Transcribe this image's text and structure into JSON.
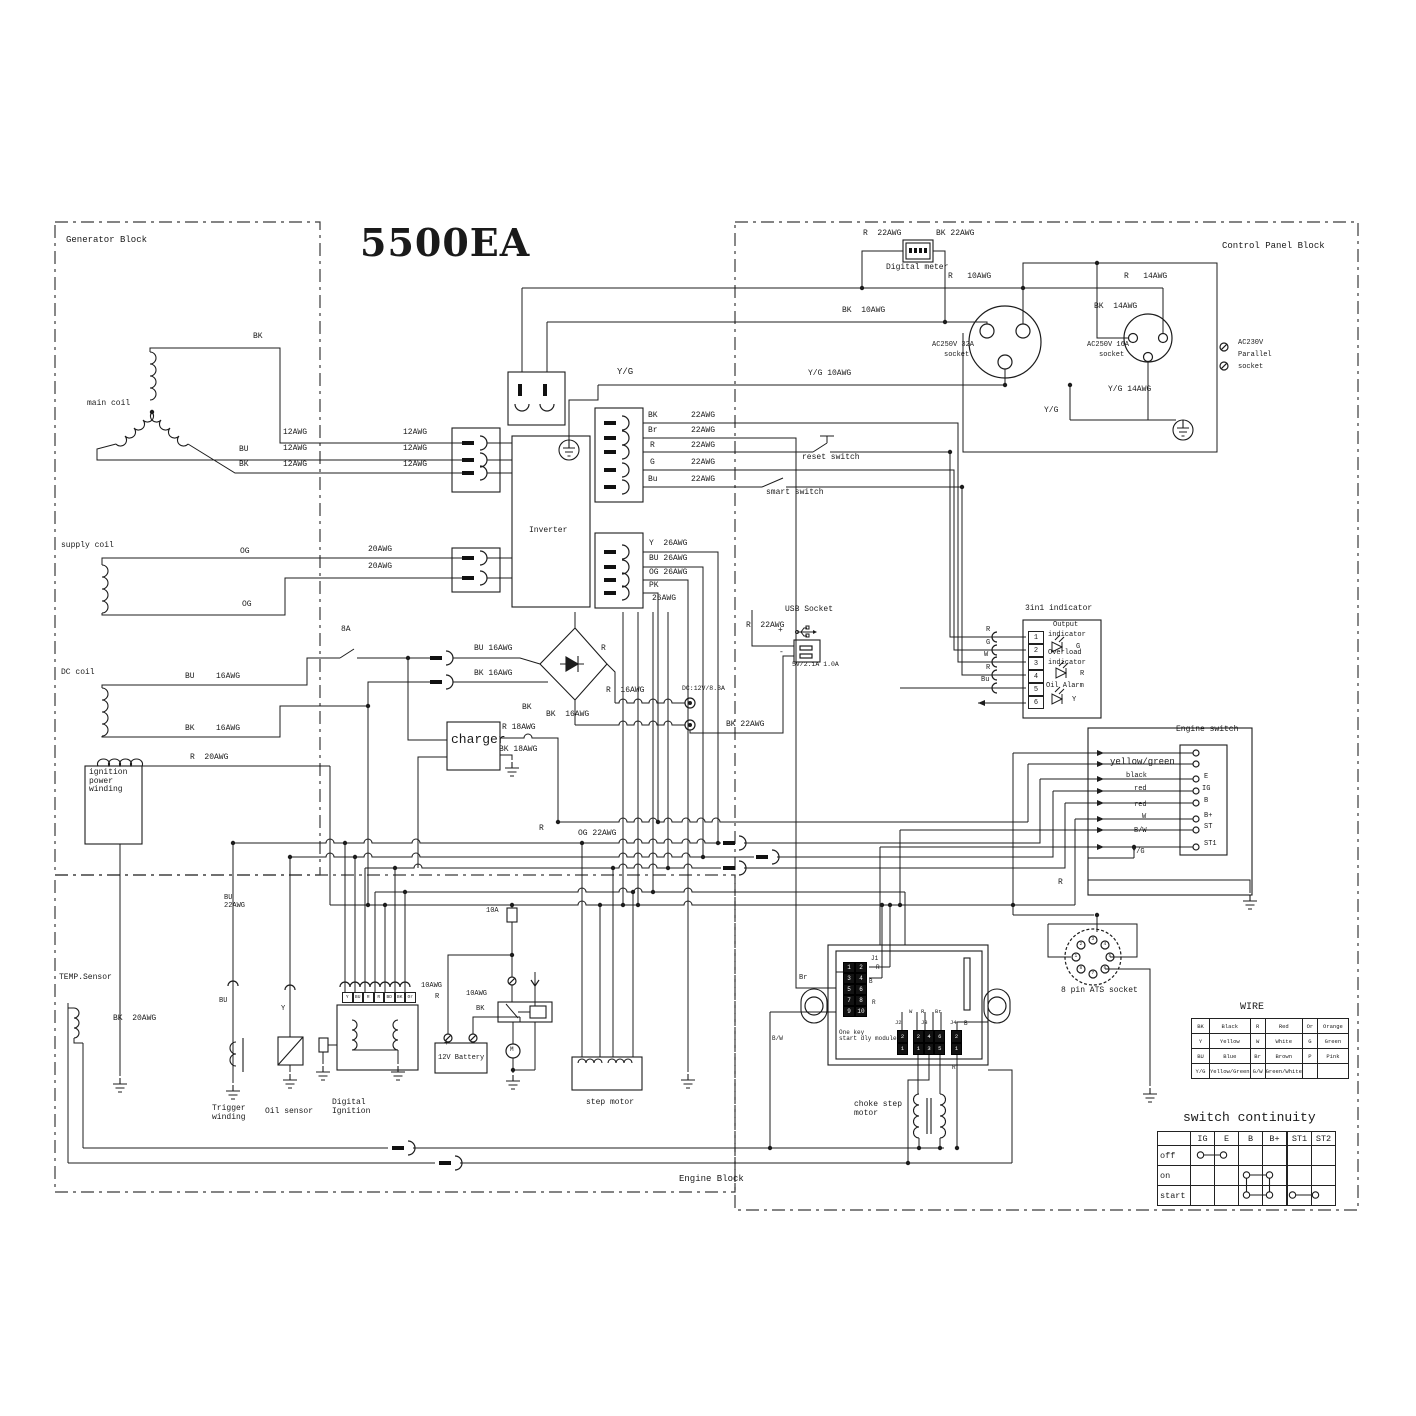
{
  "title": "5500EA",
  "blocks": {
    "generator": "Generator Block",
    "control": "Control Panel Block",
    "engine": "Engine Block"
  },
  "tables": {
    "wire": {
      "title": "WIRE",
      "rows": [
        [
          "BK",
          "Black",
          "R",
          "Red",
          "Or",
          "Orange"
        ],
        [
          "Y",
          "Yellow",
          "W",
          "White",
          "G",
          "Green"
        ],
        [
          "BU",
          "Blue",
          "Br",
          "Brown",
          "P",
          "Pink"
        ],
        [
          "Y/G",
          "Yellow/Green",
          "G/W",
          "Green/White",
          "",
          ""
        ]
      ]
    },
    "continuity": {
      "title": "switch continuity",
      "header": [
        "",
        "IG",
        "E",
        "B",
        "B+",
        "ST1",
        "ST2"
      ],
      "rows": [
        "off",
        "on",
        "start"
      ],
      "connections": {
        "off": [
          "IG",
          "E"
        ],
        "on": [
          "B",
          "B+"
        ],
        "start": [
          "B",
          "B+",
          "ST1",
          "ST2"
        ]
      }
    }
  },
  "grids": {
    "j1": {
      "x": 843,
      "y": 962,
      "cw": 12,
      "ch": 11,
      "fs": 6,
      "dark": true,
      "vals": [
        [
          "1",
          "2"
        ],
        [
          "3",
          "4"
        ],
        [
          "5",
          "6"
        ],
        [
          "7",
          "8"
        ],
        [
          "9",
          "10"
        ]
      ]
    },
    "j2": {
      "x": 897,
      "y": 1030,
      "cw": 11,
      "ch": 12.5,
      "fs": 5.5,
      "dark": true,
      "vals": [
        [
          "2"
        ],
        [
          "1"
        ]
      ]
    },
    "j3": {
      "x": 913,
      "y": 1030,
      "cw": 10.7,
      "ch": 12.5,
      "fs": 5.5,
      "dark": true,
      "vals": [
        [
          "2",
          "4",
          "6"
        ],
        [
          "1",
          "3",
          "5"
        ]
      ]
    },
    "j4": {
      "x": 951,
      "y": 1030,
      "cw": 11,
      "ch": 12.5,
      "fs": 5.5,
      "dark": true,
      "vals": [
        [
          "2"
        ],
        [
          "1"
        ]
      ]
    },
    "indicator_pins": {
      "x": 1028,
      "y": 631,
      "cw": 16,
      "ch": 13,
      "fs": 7,
      "dark": false,
      "vals": [
        [
          "1"
        ],
        [
          "2"
        ],
        [
          "3"
        ],
        [
          "4"
        ],
        [
          "5"
        ],
        [
          "6"
        ]
      ]
    },
    "di_pins": {
      "x": 342,
      "y": 992,
      "cw": 10.5,
      "ch": 11,
      "fs": 4.5,
      "dark": false,
      "vals": [
        [
          "Y",
          "BU",
          "R",
          "R",
          "BD",
          "BK",
          "Or"
        ]
      ]
    }
  },
  "ats": {
    "label": "8 pin ATS socket",
    "pins": [
      "1",
      "2",
      "3",
      "4",
      "5",
      "6",
      "7",
      "8"
    ]
  },
  "labels": [
    {
      "t": "R  22AWG",
      "x": 863,
      "y": 230
    },
    {
      "t": "BK 22AWG",
      "x": 936,
      "y": 230
    },
    {
      "t": "Digital meter",
      "x": 886,
      "y": 264,
      "n": "digital-meter-label"
    },
    {
      "t": "R   10AWG",
      "x": 948,
      "y": 273
    },
    {
      "t": "R   14AWG",
      "x": 1124,
      "y": 273
    },
    {
      "t": "BK  10AWG",
      "x": 842,
      "y": 307
    },
    {
      "t": "BK  14AWG",
      "x": 1094,
      "y": 303
    },
    {
      "t": "AC250V 32A",
      "x": 932,
      "y": 342,
      "f": 7,
      "n": "socket-32a-label"
    },
    {
      "t": "socket",
      "x": 944,
      "y": 352,
      "f": 7
    },
    {
      "t": "AC250V 16A",
      "x": 1087,
      "y": 342,
      "f": 7,
      "n": "socket-16a-label"
    },
    {
      "t": "socket",
      "x": 1099,
      "y": 352,
      "f": 7
    },
    {
      "t": "AC230V",
      "x": 1238,
      "y": 340,
      "f": 7,
      "n": "parallel-socket-label"
    },
    {
      "t": "Parallel",
      "x": 1238,
      "y": 352,
      "f": 7
    },
    {
      "t": "socket",
      "x": 1238,
      "y": 364,
      "f": 7
    },
    {
      "t": "Y/G 10AWG",
      "x": 808,
      "y": 370
    },
    {
      "t": "Y/G",
      "x": 617,
      "y": 368,
      "f": 9
    },
    {
      "t": "Y/G",
      "x": 1044,
      "y": 407
    },
    {
      "t": "Y/G 14AWG",
      "x": 1108,
      "y": 386
    },
    {
      "t": "main coil",
      "x": 87,
      "y": 400,
      "n": "main-coil-label"
    },
    {
      "t": "BK",
      "x": 253,
      "y": 333
    },
    {
      "t": "12AWG",
      "x": 283,
      "y": 429
    },
    {
      "t": "12AWG",
      "x": 283,
      "y": 445
    },
    {
      "t": "12AWG",
      "x": 283,
      "y": 461
    },
    {
      "t": "12AWG",
      "x": 403,
      "y": 429
    },
    {
      "t": "12AWG",
      "x": 403,
      "y": 445
    },
    {
      "t": "12AWG",
      "x": 403,
      "y": 461
    },
    {
      "t": "BU",
      "x": 239,
      "y": 446
    },
    {
      "t": "BK",
      "x": 239,
      "y": 461
    },
    {
      "t": "supply coil",
      "x": 61,
      "y": 542,
      "n": "supply-coil-label"
    },
    {
      "t": "OG",
      "x": 240,
      "y": 548
    },
    {
      "t": "20AWG",
      "x": 368,
      "y": 546
    },
    {
      "t": "20AWG",
      "x": 368,
      "y": 563
    },
    {
      "t": "OG",
      "x": 242,
      "y": 601
    },
    {
      "t": "DC coil",
      "x": 61,
      "y": 669,
      "n": "dc-coil-label"
    },
    {
      "t": "BU",
      "x": 185,
      "y": 673
    },
    {
      "t": "16AWG",
      "x": 216,
      "y": 673
    },
    {
      "t": "BK",
      "x": 185,
      "y": 725
    },
    {
      "t": "16AWG",
      "x": 216,
      "y": 725
    },
    {
      "t": "8A",
      "x": 341,
      "y": 626
    },
    {
      "t": "R  20AWG",
      "x": 190,
      "y": 754
    },
    {
      "t": "ignition\npower\nwinding",
      "x": 89,
      "y": 769,
      "n": "ignition-winding-label"
    },
    {
      "t": "Inverter",
      "x": 529,
      "y": 527,
      "n": "inverter-label"
    },
    {
      "t": "BK",
      "x": 648,
      "y": 412
    },
    {
      "t": "22AWG",
      "x": 691,
      "y": 412
    },
    {
      "t": "Br",
      "x": 648,
      "y": 427
    },
    {
      "t": "22AWG",
      "x": 691,
      "y": 427
    },
    {
      "t": "R",
      "x": 650,
      "y": 442
    },
    {
      "t": "22AWG",
      "x": 691,
      "y": 442
    },
    {
      "t": "G",
      "x": 650,
      "y": 459
    },
    {
      "t": "22AWG",
      "x": 691,
      "y": 459
    },
    {
      "t": "Bu",
      "x": 648,
      "y": 476
    },
    {
      "t": "22AWG",
      "x": 691,
      "y": 476
    },
    {
      "t": "reset switch",
      "x": 802,
      "y": 454,
      "n": "reset-switch-label"
    },
    {
      "t": "smart switch",
      "x": 766,
      "y": 489,
      "n": "smart-switch-label"
    },
    {
      "t": "Y  26AWG",
      "x": 649,
      "y": 540
    },
    {
      "t": "BU 26AWG",
      "x": 649,
      "y": 555
    },
    {
      "t": "OG 26AWG",
      "x": 649,
      "y": 569
    },
    {
      "t": "PK",
      "x": 649,
      "y": 582
    },
    {
      "t": "26AWG",
      "x": 652,
      "y": 595
    },
    {
      "t": "BU 16AWG",
      "x": 474,
      "y": 645
    },
    {
      "t": "BK 16AWG",
      "x": 474,
      "y": 670
    },
    {
      "t": "R",
      "x": 601,
      "y": 645
    },
    {
      "t": "R  16AWG",
      "x": 606,
      "y": 687
    },
    {
      "t": "BK",
      "x": 522,
      "y": 704
    },
    {
      "t": "BK  16AWG",
      "x": 546,
      "y": 711
    },
    {
      "t": "charger",
      "x": 451,
      "y": 733,
      "f": 13,
      "n": "charger-label"
    },
    {
      "t": "R 18AWG",
      "x": 502,
      "y": 724
    },
    {
      "t": "BK 18AWG",
      "x": 499,
      "y": 746
    },
    {
      "t": "DC:12V/8.3A",
      "x": 682,
      "y": 685,
      "f": 6.5,
      "n": "dc-output-label"
    },
    {
      "t": "BK 22AWG",
      "x": 726,
      "y": 721
    },
    {
      "t": "USB Socket",
      "x": 785,
      "y": 606,
      "n": "usb-socket-label"
    },
    {
      "t": "R  22AWG",
      "x": 746,
      "y": 622
    },
    {
      "t": "+",
      "x": 778,
      "y": 627
    },
    {
      "t": "-",
      "x": 779,
      "y": 649
    },
    {
      "t": "5V/2.1A 1.0A",
      "x": 792,
      "y": 661,
      "f": 6.5
    },
    {
      "t": "3in1 indicator",
      "x": 1025,
      "y": 605,
      "n": "indicator-label"
    },
    {
      "t": "R",
      "x": 986,
      "y": 627,
      "f": 7
    },
    {
      "t": "G",
      "x": 986,
      "y": 640,
      "f": 7
    },
    {
      "t": "W",
      "x": 984,
      "y": 652,
      "f": 7
    },
    {
      "t": "R",
      "x": 986,
      "y": 665,
      "f": 7
    },
    {
      "t": "Bu",
      "x": 981,
      "y": 677,
      "f": 7
    },
    {
      "t": "Output",
      "x": 1053,
      "y": 622,
      "f": 7
    },
    {
      "t": "indicator",
      "x": 1048,
      "y": 632,
      "f": 7
    },
    {
      "t": "G",
      "x": 1076,
      "y": 644,
      "f": 7
    },
    {
      "t": "Overload",
      "x": 1048,
      "y": 650,
      "f": 7
    },
    {
      "t": "indicator",
      "x": 1048,
      "y": 660,
      "f": 7
    },
    {
      "t": "R",
      "x": 1080,
      "y": 671,
      "f": 7
    },
    {
      "t": "Oil Alarm",
      "x": 1046,
      "y": 683,
      "f": 7
    },
    {
      "t": "Y",
      "x": 1072,
      "y": 697,
      "f": 7
    },
    {
      "t": "Engine switch",
      "x": 1176,
      "y": 726,
      "n": "engine-switch-label"
    },
    {
      "t": "E",
      "x": 1204,
      "y": 774,
      "f": 7
    },
    {
      "t": "IG",
      "x": 1202,
      "y": 786,
      "f": 7
    },
    {
      "t": "B",
      "x": 1204,
      "y": 798,
      "f": 7
    },
    {
      "t": "B+",
      "x": 1204,
      "y": 813,
      "f": 7
    },
    {
      "t": "ST",
      "x": 1204,
      "y": 824,
      "f": 7
    },
    {
      "t": "ST1",
      "x": 1204,
      "y": 841,
      "f": 7
    },
    {
      "t": "yellow/green",
      "x": 1110,
      "y": 758,
      "f": 9
    },
    {
      "t": "black",
      "x": 1126,
      "y": 773,
      "f": 7
    },
    {
      "t": "red",
      "x": 1134,
      "y": 786,
      "f": 7
    },
    {
      "t": "red",
      "x": 1134,
      "y": 802,
      "f": 7
    },
    {
      "t": "W",
      "x": 1142,
      "y": 814,
      "f": 7
    },
    {
      "t": "B/W",
      "x": 1134,
      "y": 828,
      "f": 7
    },
    {
      "t": "Y/G",
      "x": 1132,
      "y": 849,
      "f": 7
    },
    {
      "t": "R",
      "x": 1058,
      "y": 879
    },
    {
      "t": "TEMP.Sensor",
      "x": 59,
      "y": 974,
      "n": "temp-sensor-label"
    },
    {
      "t": "BK  20AWG",
      "x": 113,
      "y": 1015
    },
    {
      "t": "BU\n22AWG",
      "x": 224,
      "y": 895,
      "f": 7
    },
    {
      "t": "BU",
      "x": 219,
      "y": 998,
      "f": 7
    },
    {
      "t": "Y",
      "x": 281,
      "y": 1006,
      "f": 7
    },
    {
      "t": "Trigger\nwinding",
      "x": 212,
      "y": 1105,
      "n": "trigger-winding-label"
    },
    {
      "t": "Oil sensor",
      "x": 265,
      "y": 1108,
      "n": "oil-sensor-label"
    },
    {
      "t": "Digital\nIgnition",
      "x": 332,
      "y": 1099,
      "n": "digital-ignition-label"
    },
    {
      "t": "10AWG",
      "x": 421,
      "y": 983,
      "f": 7
    },
    {
      "t": "R",
      "x": 435,
      "y": 994,
      "f": 7
    },
    {
      "t": "10A",
      "x": 486,
      "y": 908,
      "f": 7
    },
    {
      "t": "10AWG",
      "x": 466,
      "y": 991,
      "f": 7
    },
    {
      "t": "BK",
      "x": 476,
      "y": 1006,
      "f": 7
    },
    {
      "t": "12V Battery",
      "x": 438,
      "y": 1055,
      "f": 7,
      "n": "battery-label"
    },
    {
      "t": "+",
      "x": 444,
      "y": 1040
    },
    {
      "t": "-",
      "x": 471,
      "y": 1040
    },
    {
      "t": "M",
      "x": 510,
      "y": 1047,
      "f": 6
    },
    {
      "t": "step motor",
      "x": 586,
      "y": 1099,
      "n": "step-motor-label"
    },
    {
      "t": "One key\nstart dly module",
      "x": 839,
      "y": 1030,
      "f": 6,
      "n": "start-module-label"
    },
    {
      "t": "J1",
      "x": 871,
      "y": 956,
      "f": 6
    },
    {
      "t": "R",
      "x": 876,
      "y": 965,
      "f": 6
    },
    {
      "t": "B",
      "x": 869,
      "y": 979,
      "f": 6
    },
    {
      "t": "R",
      "x": 872,
      "y": 1000,
      "f": 6
    },
    {
      "t": "Br",
      "x": 799,
      "y": 975,
      "f": 7
    },
    {
      "t": "B/W",
      "x": 772,
      "y": 1036,
      "f": 6
    },
    {
      "t": "W",
      "x": 909,
      "y": 1009,
      "f": 5.5
    },
    {
      "t": "R",
      "x": 921,
      "y": 1009,
      "f": 5.5
    },
    {
      "t": "Br",
      "x": 935,
      "y": 1009,
      "f": 5.5
    },
    {
      "t": "J2",
      "x": 895,
      "y": 1020,
      "f": 5.5
    },
    {
      "t": "J3",
      "x": 921,
      "y": 1020,
      "f": 5.5
    },
    {
      "t": "J4",
      "x": 950,
      "y": 1020,
      "f": 5.5
    },
    {
      "t": "B",
      "x": 964,
      "y": 1021,
      "f": 6
    },
    {
      "t": "R",
      "x": 952,
      "y": 1065,
      "f": 6
    },
    {
      "t": "choke step\nmotor",
      "x": 854,
      "y": 1101,
      "n": "choke-motor-label"
    },
    {
      "t": "OG 22AWG",
      "x": 578,
      "y": 830
    },
    {
      "t": "R",
      "x": 539,
      "y": 825
    },
    {
      "t": "8 pin ATS socket",
      "x": 1061,
      "y": 987,
      "n": "ats-socket-label"
    }
  ]
}
